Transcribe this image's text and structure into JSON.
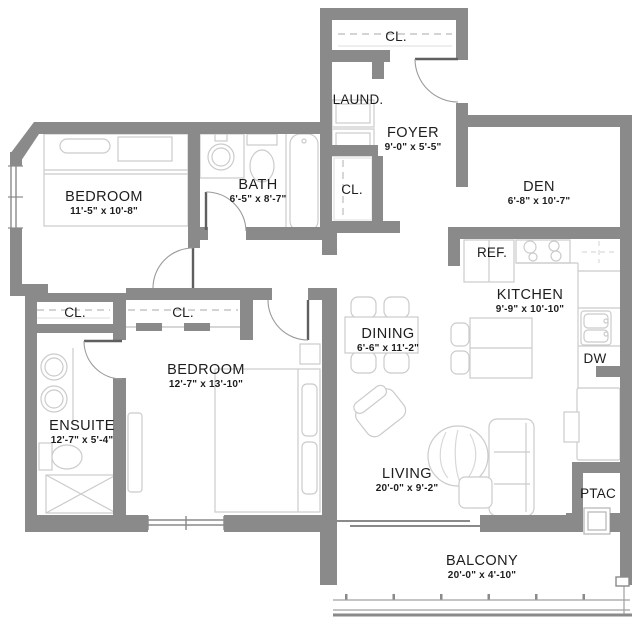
{
  "colors": {
    "wall": "#8a8a8a",
    "furniture": "#cccccc",
    "text": "#1d1d1d"
  },
  "rooms": {
    "bedroom_1": {
      "name": "BEDROOM",
      "dims": "11'-5\" x 10'-8\""
    },
    "bath": {
      "name": "BATH",
      "dims": "6'-5\" x 8'-7\""
    },
    "laundry": {
      "name": "LAUND."
    },
    "closet_entry": {
      "name": "CL."
    },
    "foyer": {
      "name": "FOYER",
      "dims": "9'-0\" x 5'-5\""
    },
    "closet_foyer": {
      "name": "CL."
    },
    "den": {
      "name": "DEN",
      "dims": "6'-8\" x 10'-7\""
    },
    "fridge": {
      "name": "REF."
    },
    "kitchen": {
      "name": "KITCHEN",
      "dims": "9'-9\" x 10'-10\""
    },
    "dishwasher": {
      "name": "DW"
    },
    "dining": {
      "name": "DINING",
      "dims": "6'-6\" x 11'-2\""
    },
    "closet_hall": {
      "name": "CL."
    },
    "closet_bedroom2": {
      "name": "CL."
    },
    "bedroom_2": {
      "name": "BEDROOM",
      "dims": "12'-7\" x 13'-10\""
    },
    "ensuite": {
      "name": "ENSUITE",
      "dims": "12'-7\" x 5'-4\""
    },
    "living": {
      "name": "LIVING",
      "dims": "20'-0\" x 9'-2\""
    },
    "ptac": {
      "name": "PTAC"
    },
    "balcony": {
      "name": "BALCONY",
      "dims": "20'-0\" x 4'-10\""
    }
  }
}
